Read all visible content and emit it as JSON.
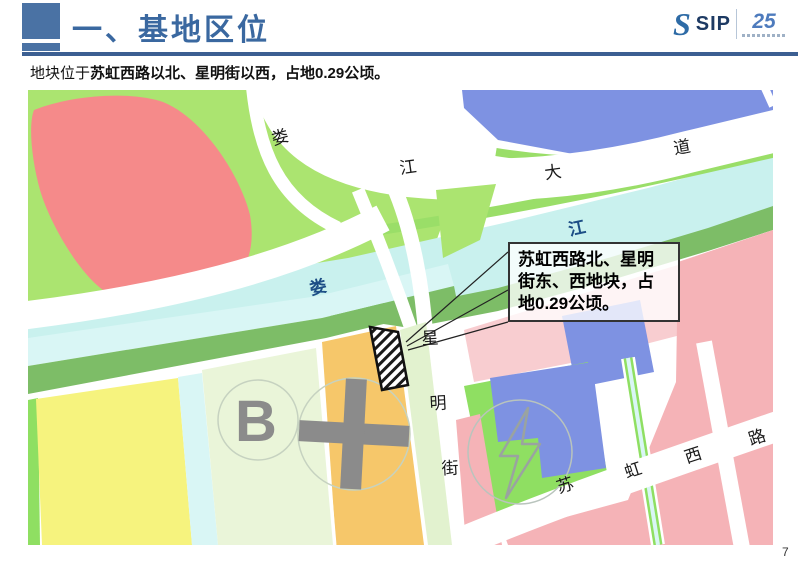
{
  "header": {
    "title": "一、基地区位"
  },
  "logo": {
    "brand": "SIP",
    "anniversary": "25"
  },
  "subtitle": {
    "prefix": "地块位于",
    "emphasis": "苏虹西路以北、星明街以西，占地0.29公顷。"
  },
  "map": {
    "callout": {
      "text": "苏虹西路北、星明街东、西地块，占地0.29公顷。"
    },
    "roads": {
      "loujiang_avenue": [
        "娄",
        "江",
        "大",
        "道"
      ],
      "loujiang_river": [
        "娄",
        "江"
      ],
      "xingming_street": [
        "星",
        "明",
        "街"
      ],
      "suhong_west_road": [
        "苏",
        "虹",
        "西",
        "路"
      ]
    },
    "markers": {
      "b_block": "B"
    }
  },
  "page_number": "7",
  "palette": {
    "title_blue": "#3a68a0",
    "rule_blue": "#3c5f92",
    "grass_green": "#abe470",
    "red_parcel": "#f58a8a",
    "water_blue": "#7e92e2",
    "river_cyan": "#c9f1ee",
    "canal_cyan": "#d9f6f5",
    "bank_green": "#7dbd67",
    "bright_green": "#8fdf62",
    "yellow_parcel": "#f6f37e",
    "b_parcel": "#eaf5d9",
    "orange_parcel": "#f6c76a",
    "pink_parcel": "#f5b3b7",
    "pink_light": "#f8cdd0",
    "icon_grey": "#8b8b8b"
  }
}
